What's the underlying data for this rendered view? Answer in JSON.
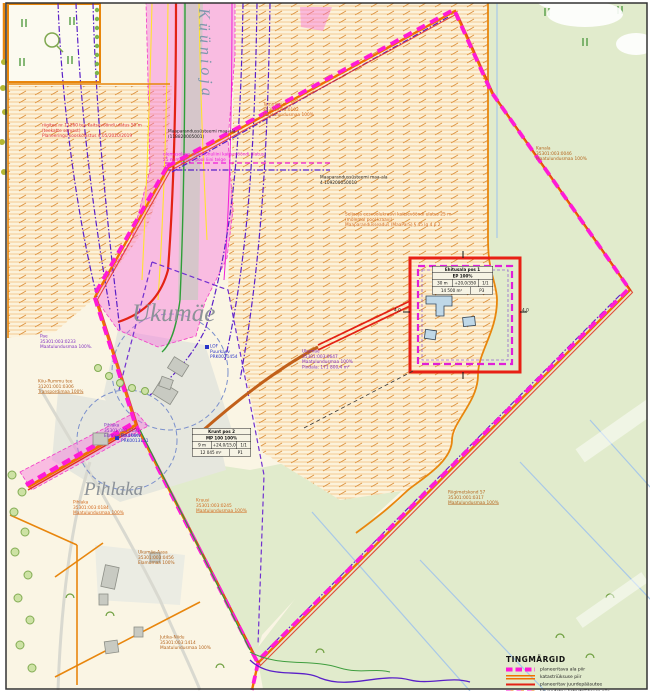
{
  "colors": {
    "plan_boundary_magenta": "#FF1BD6",
    "cadastral_orange": "#F07000",
    "access_road_red": "#E32215",
    "utility_purple": "#5A20C8",
    "field_hatch_orange": "#DC9240",
    "grass_green": "#E1EBCC",
    "corridor_pink": "#F86EDE",
    "well_blue": "#2A35C8"
  },
  "place_names": {
    "stream": "Küünioja",
    "farm_upper": "Ukumäe",
    "farm_lower": "Pihlaka"
  },
  "notes": {
    "road": {
      "l1": "riigitee nr 11260 tee kaitsevööndi ulatus 50 m",
      "l2": "(teekatte servast)",
      "l3": "Planeeringu kooskõlastus 4.05/2020/2019"
    },
    "drain1": {
      "l1": "Maaparandussüsteemi maa-ala",
      "l2": "(118820005001)"
    },
    "drain2": {
      "l1": "Maaparandussüsteemi maa-ala",
      "l2": "4 109200050010"
    },
    "powerline": {
      "l1": "olemasoleva elektriõhuliini kaitsevööndi ulatus",
      "l2": "25 m mõlemal pool liini telge"
    },
    "ditch": {
      "l1": "Seljaoja eesvoolukraavi kaitsevööndi ulatus 25 m",
      "l2": "(mõlemal pool kraavi)",
      "l3": "Maaparandusseadus (MaaParS) § 45 lg 4 p 2"
    }
  },
  "parcels": {
    "tammeoja": {
      "l1": "Tammeoja",
      "l2": "35301:003:0102",
      "l3": "Maatulundusmaa 100%"
    },
    "kanala": {
      "l1": "Kanala",
      "l2": "35301:003:0046",
      "l3": "Maatulundusmaa 100%"
    },
    "ukumae": {
      "l1": "Ukumäe",
      "l2": "35301:003:0647",
      "l3": "Maatulundusmaa 100%",
      "l4": "Pindala: 171 800,4 m²"
    },
    "pae": {
      "l1": "Pae",
      "l2": "35301:003:0233",
      "l3": "Maatulundusmaa 100%."
    },
    "kiiu_tee": {
      "l1": "Kiiu-Rummu tee",
      "l2": "31201:001:0306",
      "l3": "Transpordimaa 100%"
    },
    "pihlaka_elamu": {
      "l1": "Pihlaka",
      "l2": "35301:003:0181",
      "l3": "Elamumaa 100%"
    },
    "pihlaka_maa": {
      "l1": "Pihlaka",
      "l2": "35301:003:0184",
      "l3": "Maatulundusmaa 100%"
    },
    "kruusi": {
      "l1": "Kruusi",
      "l2": "35301:003:0245",
      "l3": "Maatulundusmaa 100%"
    },
    "aasa": {
      "l1": "Ukumäe-Aasa",
      "l2": "35301:003:0456",
      "l3": "Elamumaa 100%"
    },
    "niidu": {
      "l1": "Jutika-Niidu",
      "l2": "35301:003:1414",
      "l3": "Maatulundusmaa 100%"
    },
    "metskond": {
      "l1": "Riigimetskond 57",
      "l2": "35301:001:0317",
      "l3": "Maatulundusmaa 100%"
    }
  },
  "wells": {
    "w1": {
      "l1": "LOF",
      "l2": "Puurkaev",
      "l3": "PRK0021454"
    },
    "w2": {
      "l1": "Puurkaev",
      "l2": "PRK0013151"
    }
  },
  "dimensions": {
    "left": "4,0",
    "right": "4,0"
  },
  "tables": {
    "pos1": {
      "title": "Ehitusala pos 1",
      "subtitle": "EP 100%",
      "r1c1": "30 m",
      "r1c2": "+20,0/350",
      "r1c3": "1/1",
      "r2c1": "14 500 m²",
      "r2c2": "P3"
    },
    "pos2": {
      "title": "Krunt pos 2",
      "subtitle": "MP 100 100%",
      "r1c1": "9 m",
      "r1c2": "+24,0/15,0",
      "r1c3": "1/1",
      "r2c1": "12 045 m²",
      "r2c2": "P1"
    }
  },
  "legend": {
    "title": "TINGMÄRGID",
    "items": [
      {
        "label": "planeeritava ala piir"
      },
      {
        "label": "katastriüksuse piir"
      },
      {
        "label": "planeeritav juurdepääsutee"
      },
      {
        "label": "kavandatav katastriüksuse piir"
      }
    ]
  }
}
